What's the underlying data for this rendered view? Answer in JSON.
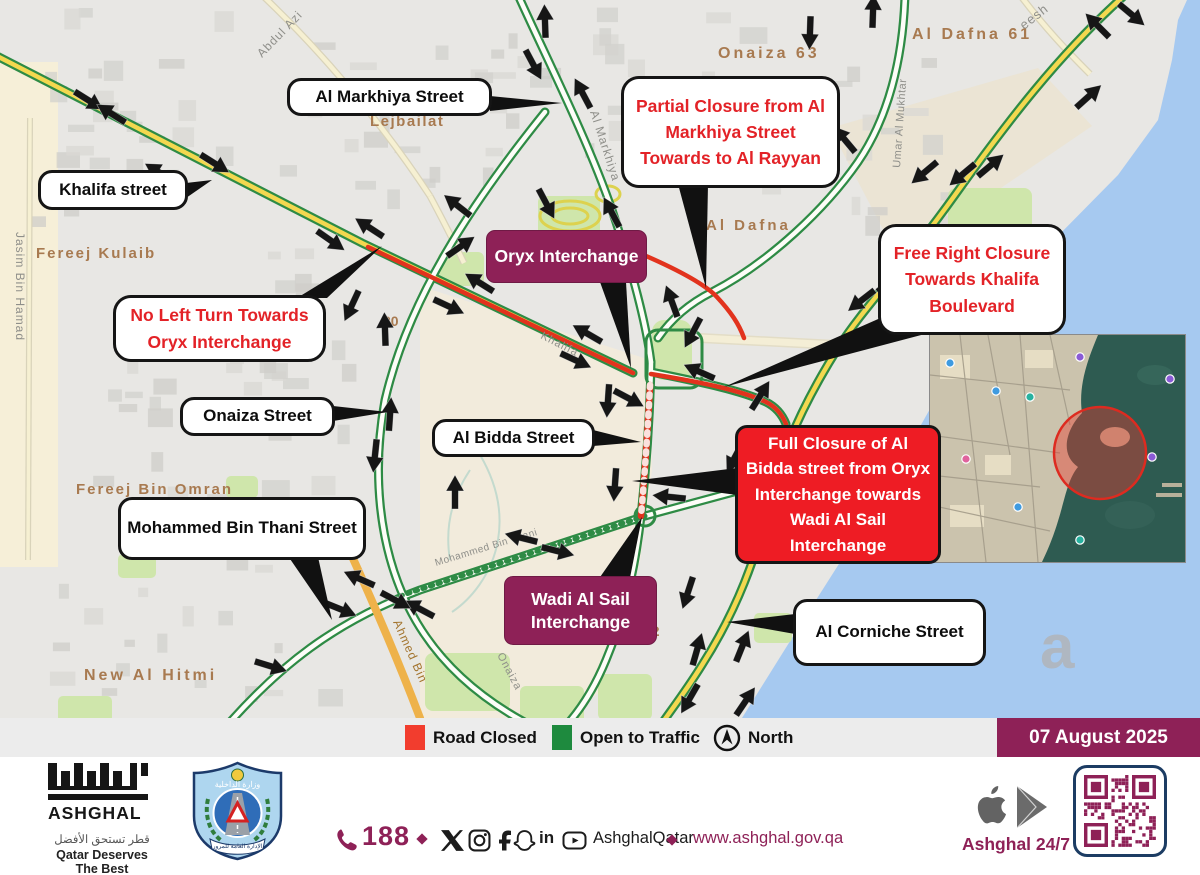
{
  "map": {
    "callouts": {
      "al_markhiya": "Al Markhiya Street",
      "khalifa": "Khalifa street",
      "onaiza": "Onaiza Street",
      "al_bidda": "Al Bidda Street",
      "mohammed_bin_thani": "Mohammed Bin Thani Street",
      "al_corniche": "Al Corniche Street",
      "oryx": "Oryx Interchange",
      "wadi": "Wadi Al Sail Interchange",
      "partial_closure": "Partial Closure from Al Markhiya Street Towards to Al Rayyan",
      "no_left_turn": "No Left Turn Towards Oryx Interchange",
      "free_right": "Free Right Closure Towards Khalifa Boulevard",
      "full_closure": "Full Closure of Al Bidda street from Oryx Interchange towards Wadi Al Sail Interchange"
    },
    "labels": [
      {
        "t": "Fereej  Kulaib",
        "x": 36,
        "y": 258,
        "r": 0,
        "c": "d",
        "s": 15,
        "ls": 2
      },
      {
        "t": "Lejbailat",
        "x": 370,
        "y": 126,
        "r": 0,
        "c": "d",
        "s": 15,
        "ls": 1.5
      },
      {
        "t": "Onaiza  63",
        "x": 718,
        "y": 58,
        "r": 0,
        "c": "d",
        "s": 16,
        "ls": 3
      },
      {
        "t": "Al  Dafna  61",
        "x": 912,
        "y": 39,
        "r": 0,
        "c": "d",
        "s": 16,
        "ls": 3
      },
      {
        "t": "Al  Dafna",
        "x": 706,
        "y": 230,
        "r": 0,
        "c": "d",
        "s": 15,
        "ls": 3
      },
      {
        "t": "Fereej  Bin  Omran",
        "x": 76,
        "y": 494,
        "r": 0,
        "c": "d",
        "s": 15,
        "ls": 2
      },
      {
        "t": "New  Al  Hitmi",
        "x": 84,
        "y": 680,
        "r": 0,
        "c": "d",
        "s": 16,
        "ls": 3
      },
      {
        "t": "20",
        "x": 383,
        "y": 326,
        "r": 0,
        "c": "d",
        "s": 14,
        "ls": 0
      },
      {
        "t": "12",
        "x": 644,
        "y": 636,
        "r": 0,
        "c": "d",
        "s": 14,
        "ls": 0
      },
      {
        "t": "Jasim Bin Hamad",
        "x": 16,
        "y": 232,
        "r": 90,
        "c": "s",
        "s": 12,
        "ls": 1
      },
      {
        "t": "Abdul Azi",
        "x": 262,
        "y": 58,
        "r": -46,
        "c": "s",
        "s": 12,
        "ls": 1
      },
      {
        "t": "Al Markhiya",
        "x": 590,
        "y": 112,
        "r": 72,
        "c": "s",
        "s": 12,
        "ls": 1
      },
      {
        "t": "Umar Al Mukhtar",
        "x": 900,
        "y": 168,
        "r": -86,
        "c": "s",
        "s": 11,
        "ls": 0.5
      },
      {
        "t": "eesh",
        "x": 1024,
        "y": 30,
        "r": -38,
        "c": "s",
        "s": 13,
        "ls": 1
      },
      {
        "t": "Khalifa",
        "x": 540,
        "y": 338,
        "r": 27,
        "c": "s",
        "s": 11,
        "ls": 1
      },
      {
        "t": "Onaiza",
        "x": 497,
        "y": 655,
        "r": 62,
        "c": "s",
        "s": 11,
        "ls": 1
      },
      {
        "t": "Mohammed Bin Thani",
        "x": 436,
        "y": 566,
        "r": -17,
        "c": "s",
        "s": 10,
        "ls": 0.5
      },
      {
        "t": "Ahmed Bin",
        "x": 393,
        "y": 622,
        "r": 66,
        "c": "o",
        "s": 12,
        "ls": 1
      },
      {
        "t": "a",
        "x": 1040,
        "y": 668,
        "r": 0,
        "c": "w",
        "s": 62,
        "ls": 0
      }
    ],
    "arrows": [
      [
        88,
        100,
        32
      ],
      [
        112,
        114,
        212
      ],
      [
        160,
        173,
        212
      ],
      [
        214,
        163,
        32
      ],
      [
        330,
        240,
        35
      ],
      [
        370,
        228,
        213
      ],
      [
        458,
        206,
        218
      ],
      [
        460,
        247,
        325
      ],
      [
        352,
        305,
        115
      ],
      [
        385,
        330,
        268
      ],
      [
        480,
        283,
        212
      ],
      [
        448,
        306,
        25
      ],
      [
        575,
        360,
        25
      ],
      [
        588,
        334,
        210
      ],
      [
        545,
        22,
        268
      ],
      [
        533,
        64,
        62
      ],
      [
        583,
        94,
        242
      ],
      [
        546,
        203,
        62
      ],
      [
        612,
        213,
        242
      ],
      [
        810,
        32,
        92
      ],
      [
        873,
        12,
        272
      ],
      [
        1098,
        26,
        225
      ],
      [
        1131,
        14,
        40
      ],
      [
        1088,
        97,
        318
      ],
      [
        963,
        174,
        140
      ],
      [
        990,
        166,
        320
      ],
      [
        925,
        172,
        140
      ],
      [
        725,
        140,
        140
      ],
      [
        773,
        120,
        320
      ],
      [
        845,
        140,
        230
      ],
      [
        862,
        300,
        142
      ],
      [
        890,
        282,
        322
      ],
      [
        760,
        396,
        302
      ],
      [
        735,
        457,
        118
      ],
      [
        688,
        592,
        108
      ],
      [
        697,
        650,
        286
      ],
      [
        742,
        647,
        292
      ],
      [
        690,
        698,
        120
      ],
      [
        745,
        702,
        304
      ],
      [
        608,
        400,
        94
      ],
      [
        615,
        484,
        94
      ],
      [
        670,
        497,
        186
      ],
      [
        390,
        415,
        274
      ],
      [
        375,
        455,
        96
      ],
      [
        455,
        493,
        270
      ],
      [
        522,
        538,
        194
      ],
      [
        557,
        551,
        14
      ],
      [
        420,
        609,
        208
      ],
      [
        395,
        600,
        28
      ],
      [
        360,
        579,
        204
      ],
      [
        340,
        609,
        22
      ],
      [
        270,
        666,
        17
      ],
      [
        693,
        332,
        118
      ],
      [
        700,
        372,
        204
      ],
      [
        672,
        302,
        250
      ],
      [
        628,
        398,
        28
      ]
    ]
  },
  "legend": {
    "road_closed": "Road Closed",
    "open_to_traffic": "Open to Traffic",
    "north": "North",
    "date": "07 August 2025"
  },
  "footer": {
    "logo_name": "ASHGHAL",
    "tagline_ar": "قطر تستحق الأفضل",
    "tagline_en": "Qatar Deserves The Best",
    "phone": "188",
    "handle": "AshghalQatar",
    "website": "www.ashghal.gov.qa",
    "app_name": "Ashghal 24/7"
  },
  "colors": {
    "maroon": "#8e2157",
    "red_box": "#ee1c24",
    "road_red": "#e2331d",
    "legend_green": "#1e8a3e",
    "water": "#a6c9f0"
  }
}
